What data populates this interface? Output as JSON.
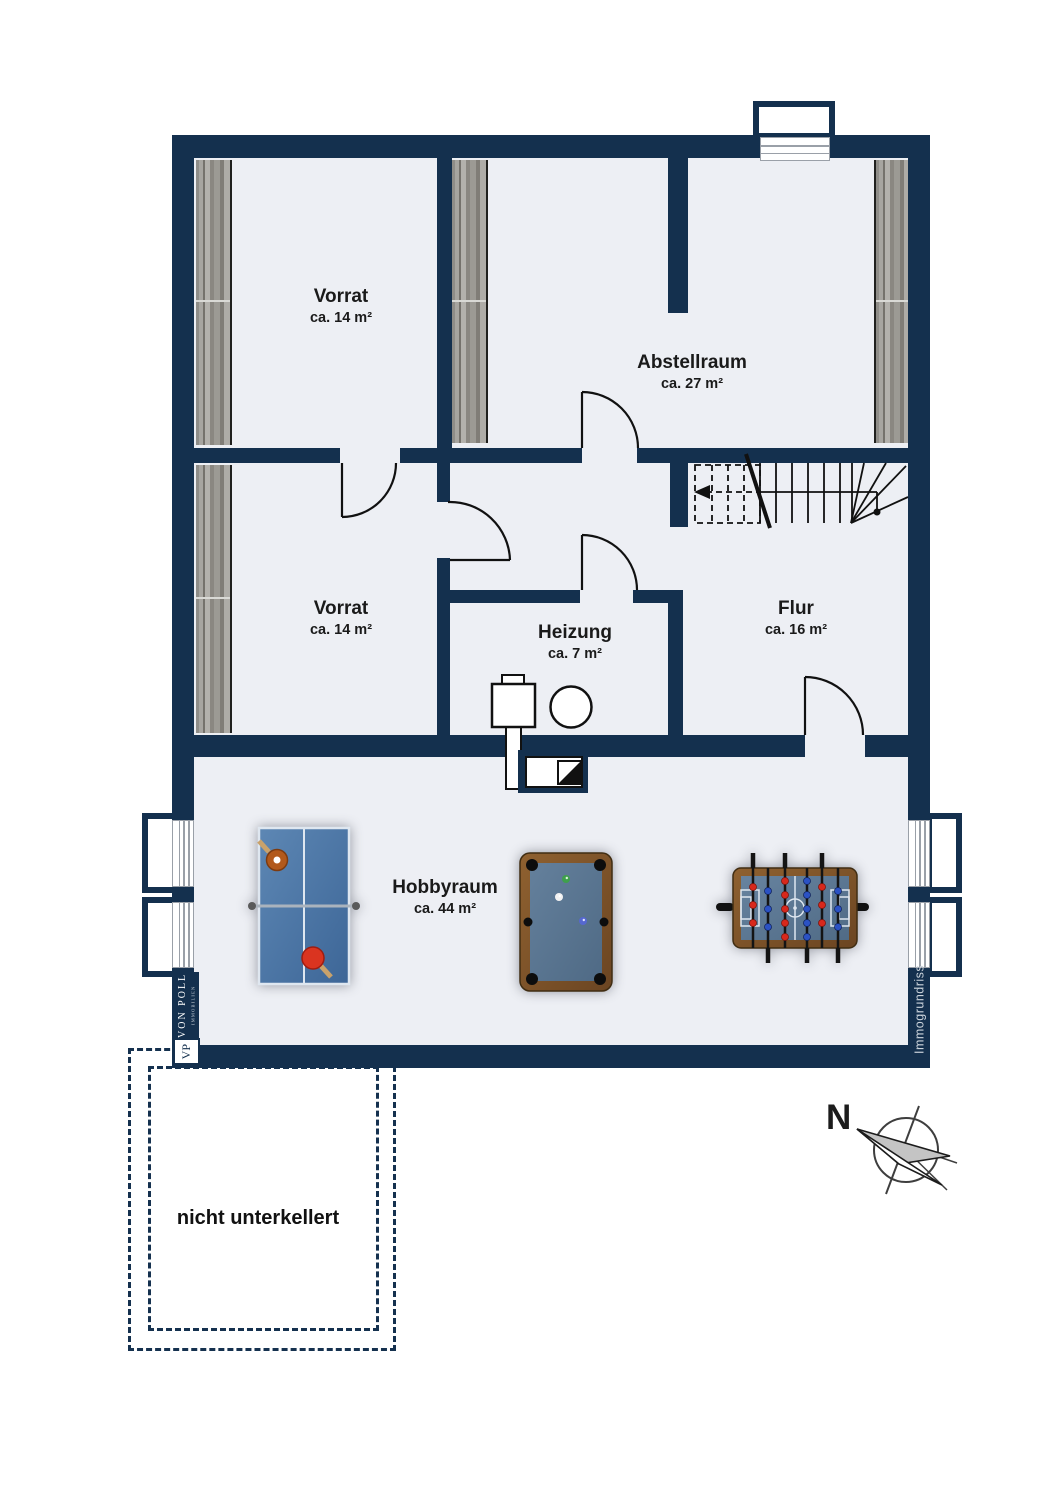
{
  "plan": {
    "rooms": [
      {
        "key": "vorrat_top",
        "name": "Vorrat",
        "area": "ca. 14 m²"
      },
      {
        "key": "abstellraum",
        "name": "Abstellraum",
        "area": "ca. 27 m²"
      },
      {
        "key": "vorrat_mid",
        "name": "Vorrat",
        "area": "ca. 14 m²"
      },
      {
        "key": "heizung",
        "name": "Heizung",
        "area": "ca. 7 m²"
      },
      {
        "key": "flur",
        "name": "Flur",
        "area": "ca. 16 m²"
      },
      {
        "key": "hobbyraum",
        "name": "Hobbyraum",
        "area": "ca. 44 m²"
      }
    ],
    "annotations": {
      "nicht_unterkellert": "nicht unterkellert",
      "compass_north": "N",
      "watermark": "Immogrundriss"
    },
    "branding": {
      "name": "VON POLL",
      "division": "IMMOBILIEN",
      "monogram": "VP"
    },
    "icons": [
      "compass-rose-icon",
      "stairs",
      "door-arc",
      "boiler-icon",
      "water-tank-icon",
      "chimney-icon",
      "table-tennis-table",
      "billiard-table",
      "foosball-table",
      "window",
      "light-well",
      "shelf"
    ],
    "colors": {
      "wall": "#14304e",
      "floor": "#edeff4",
      "line": "#111111",
      "table_blue": "#46719f",
      "wood_brown": "#7c5228",
      "felt_blue": "#5c7a99",
      "paddle_red": "#d93025",
      "paddle_orange": "#b2591b"
    }
  }
}
